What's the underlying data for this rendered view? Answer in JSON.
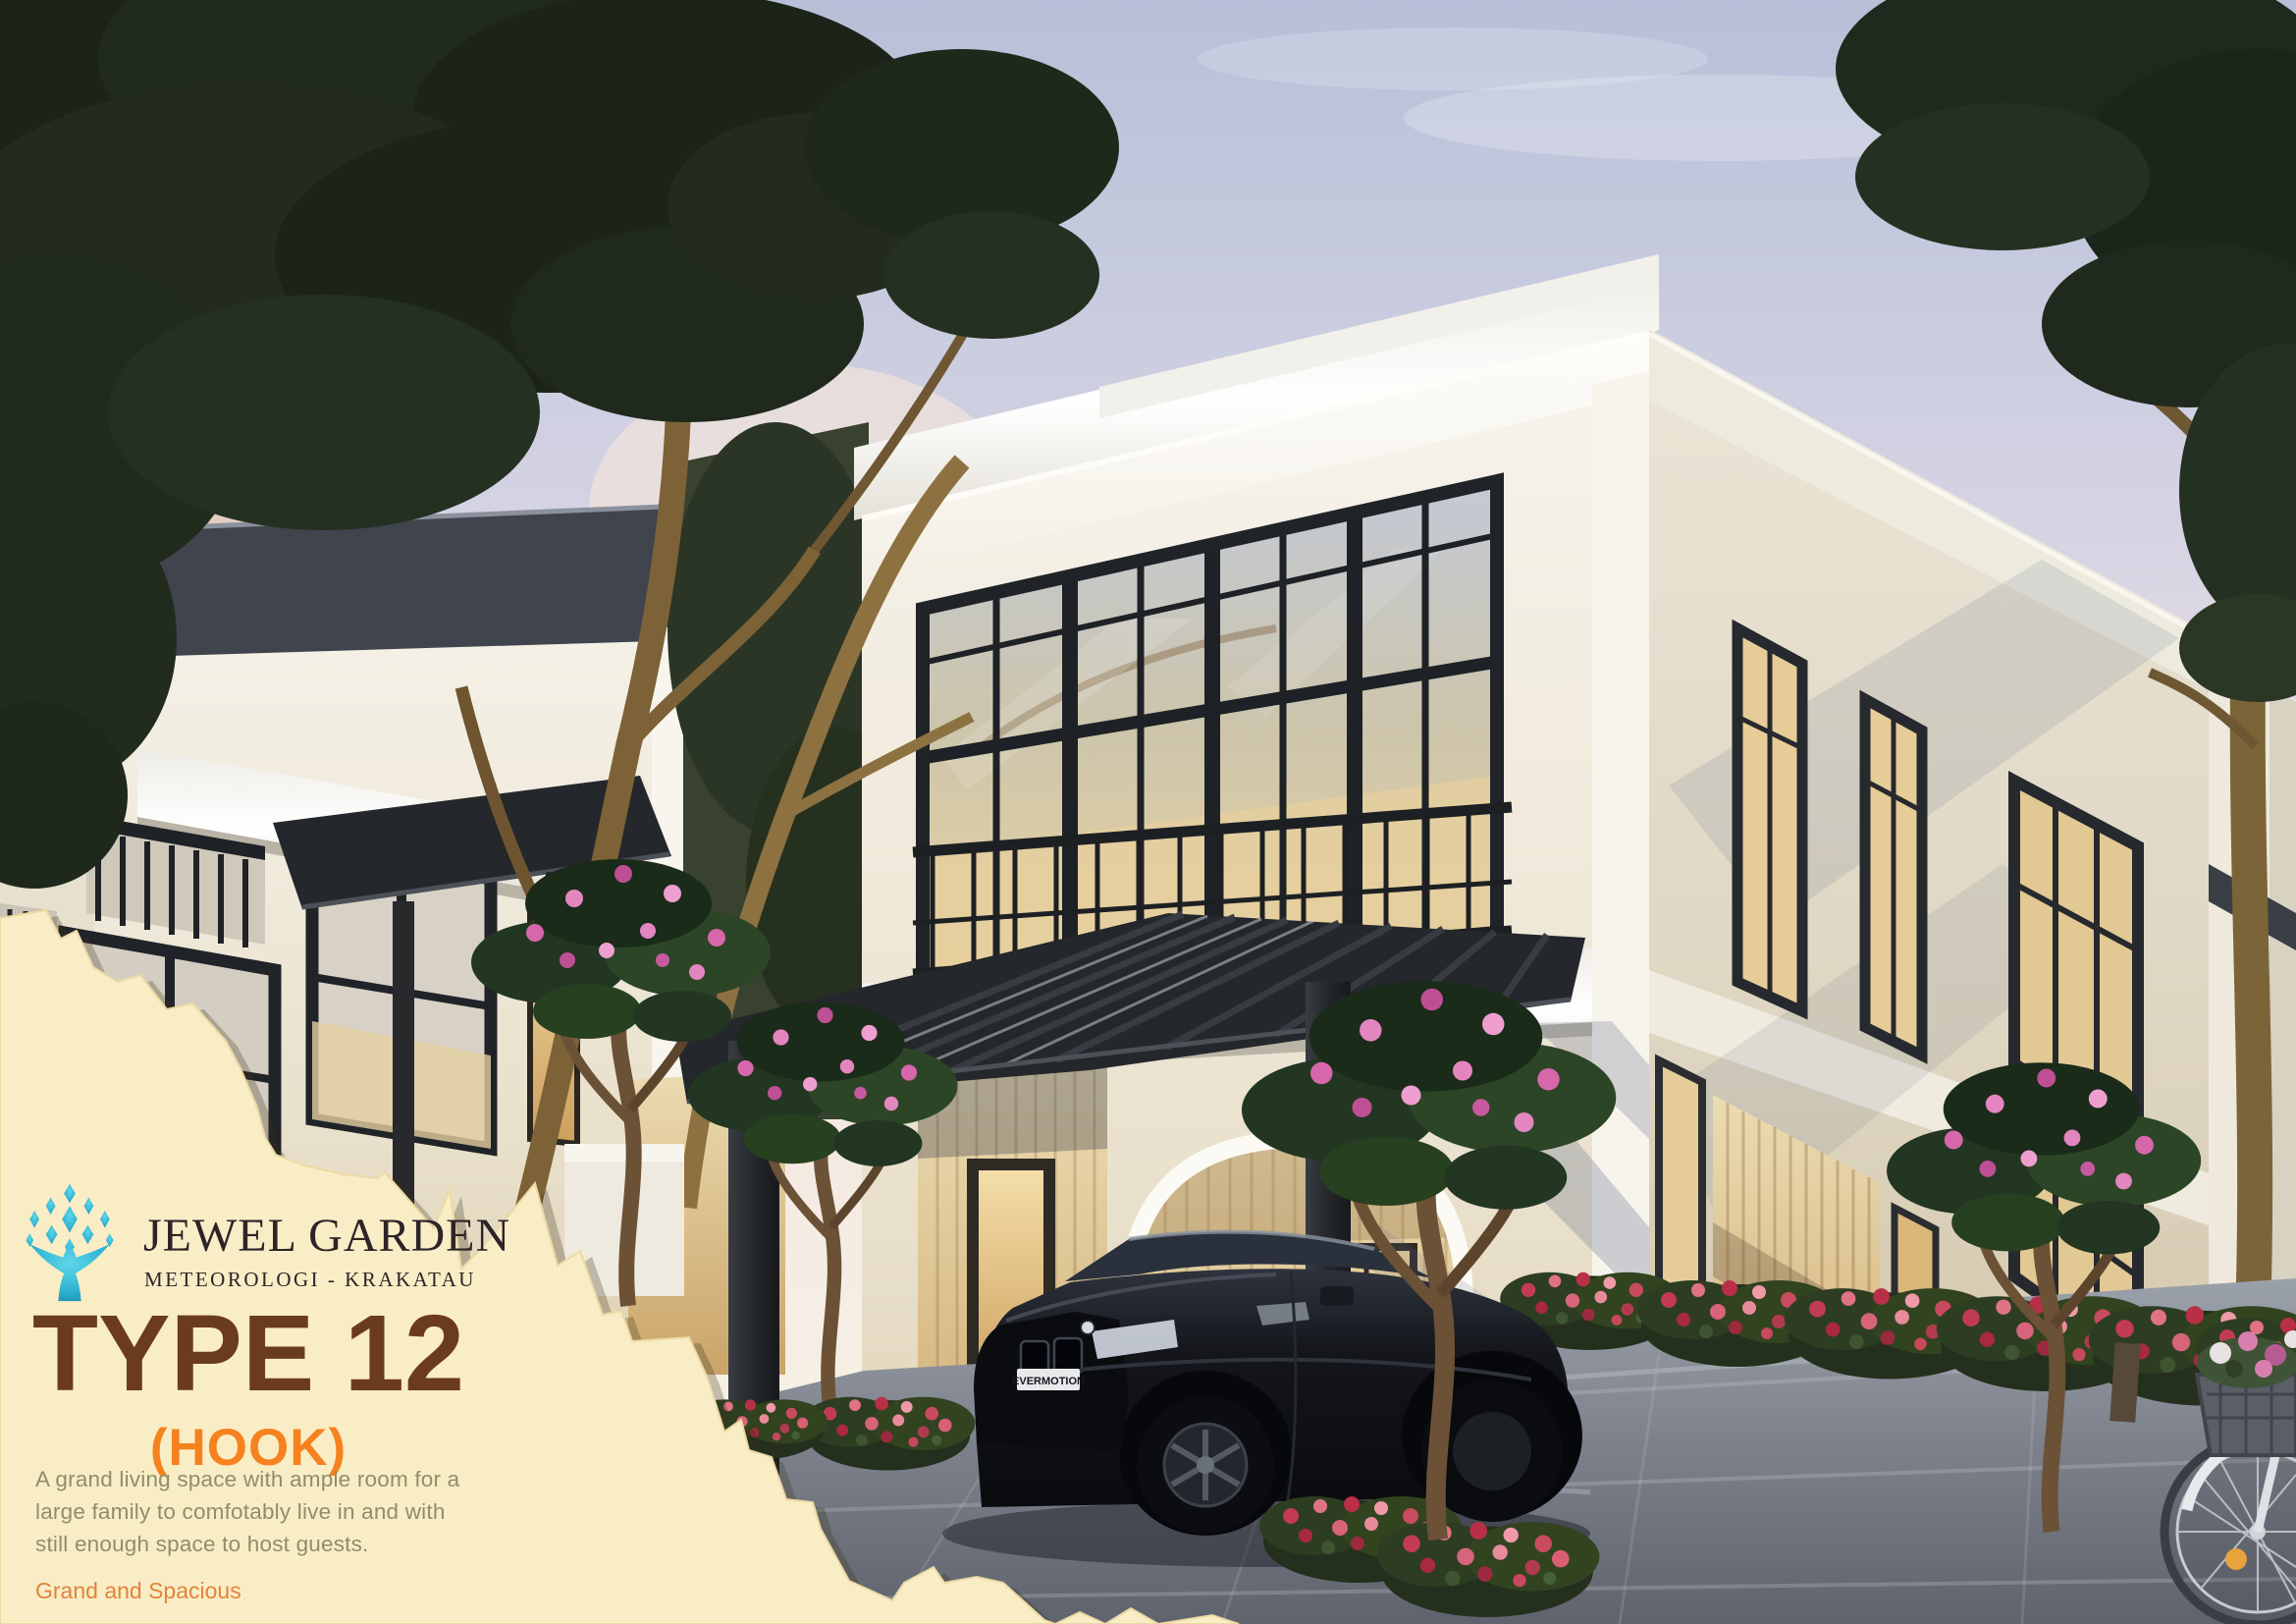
{
  "brand": {
    "name": "JEWEL GARDEN",
    "location": "METEOROLOGI - KRAKATAU",
    "logo_icon": "jewel-tree-icon"
  },
  "listing": {
    "title": "TYPE 12",
    "subtitle": "(HOOK)",
    "description_lines": [
      "A grand living space with ample room for a",
      "large family to comfotably live in and with",
      "still enough space to host guests."
    ],
    "tagline": "Grand and Spacious"
  },
  "scene": {
    "license_plate": "EVERMOTION",
    "alt": "Dusk 3D rendering of two-story modern classic white houses with black window frames, carport pergola, black sedan, plumeria trees, red flower hedges, paved driveway and a bicycle with a flower basket"
  },
  "colors": {
    "paper_cream": "#f9edc6",
    "title_brown": "#6b3b1e",
    "subtitle_orange": "#f5821f",
    "description_olive": "#8f8e6c",
    "tagline_orange": "#e2833c",
    "brand_text": "#2d2427",
    "logo_teal": "#35bcd9",
    "sky_top": "#bcc4db",
    "sunset_glow": "#f2b583",
    "window_frame": "#24272b",
    "wall_white": "#f4f0e6",
    "warm_light": "#e9d09c",
    "pavement_gray": "#7e838d",
    "foliage_dark": "#1e2a1b",
    "flower_red": "#c23b52",
    "flower_pink": "#d767ab"
  }
}
